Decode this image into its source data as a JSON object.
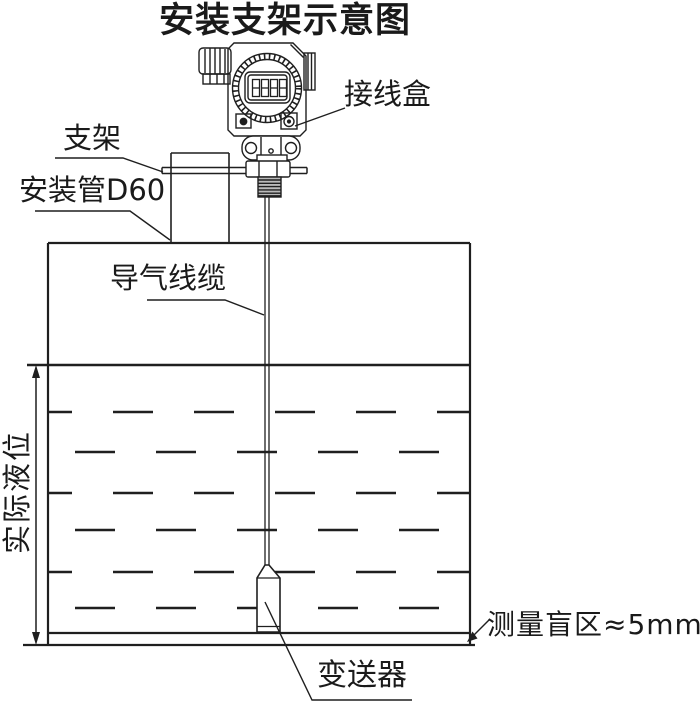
{
  "title": "安装支架示意图",
  "labels": {
    "junction_box": "接线盒",
    "bracket": "支架",
    "mounting_pipe": "安装管D60",
    "air_cable": "导气线缆",
    "actual_level": "实际液位",
    "transmitter_probe": "变送器",
    "blind_zone": "测量盲区≈5mm"
  },
  "device": {
    "lcd_digits": "8888"
  },
  "colors": {
    "line": "#1f1f1f",
    "background": "#ffffff",
    "thread_fill": "#b9b9b9"
  }
}
